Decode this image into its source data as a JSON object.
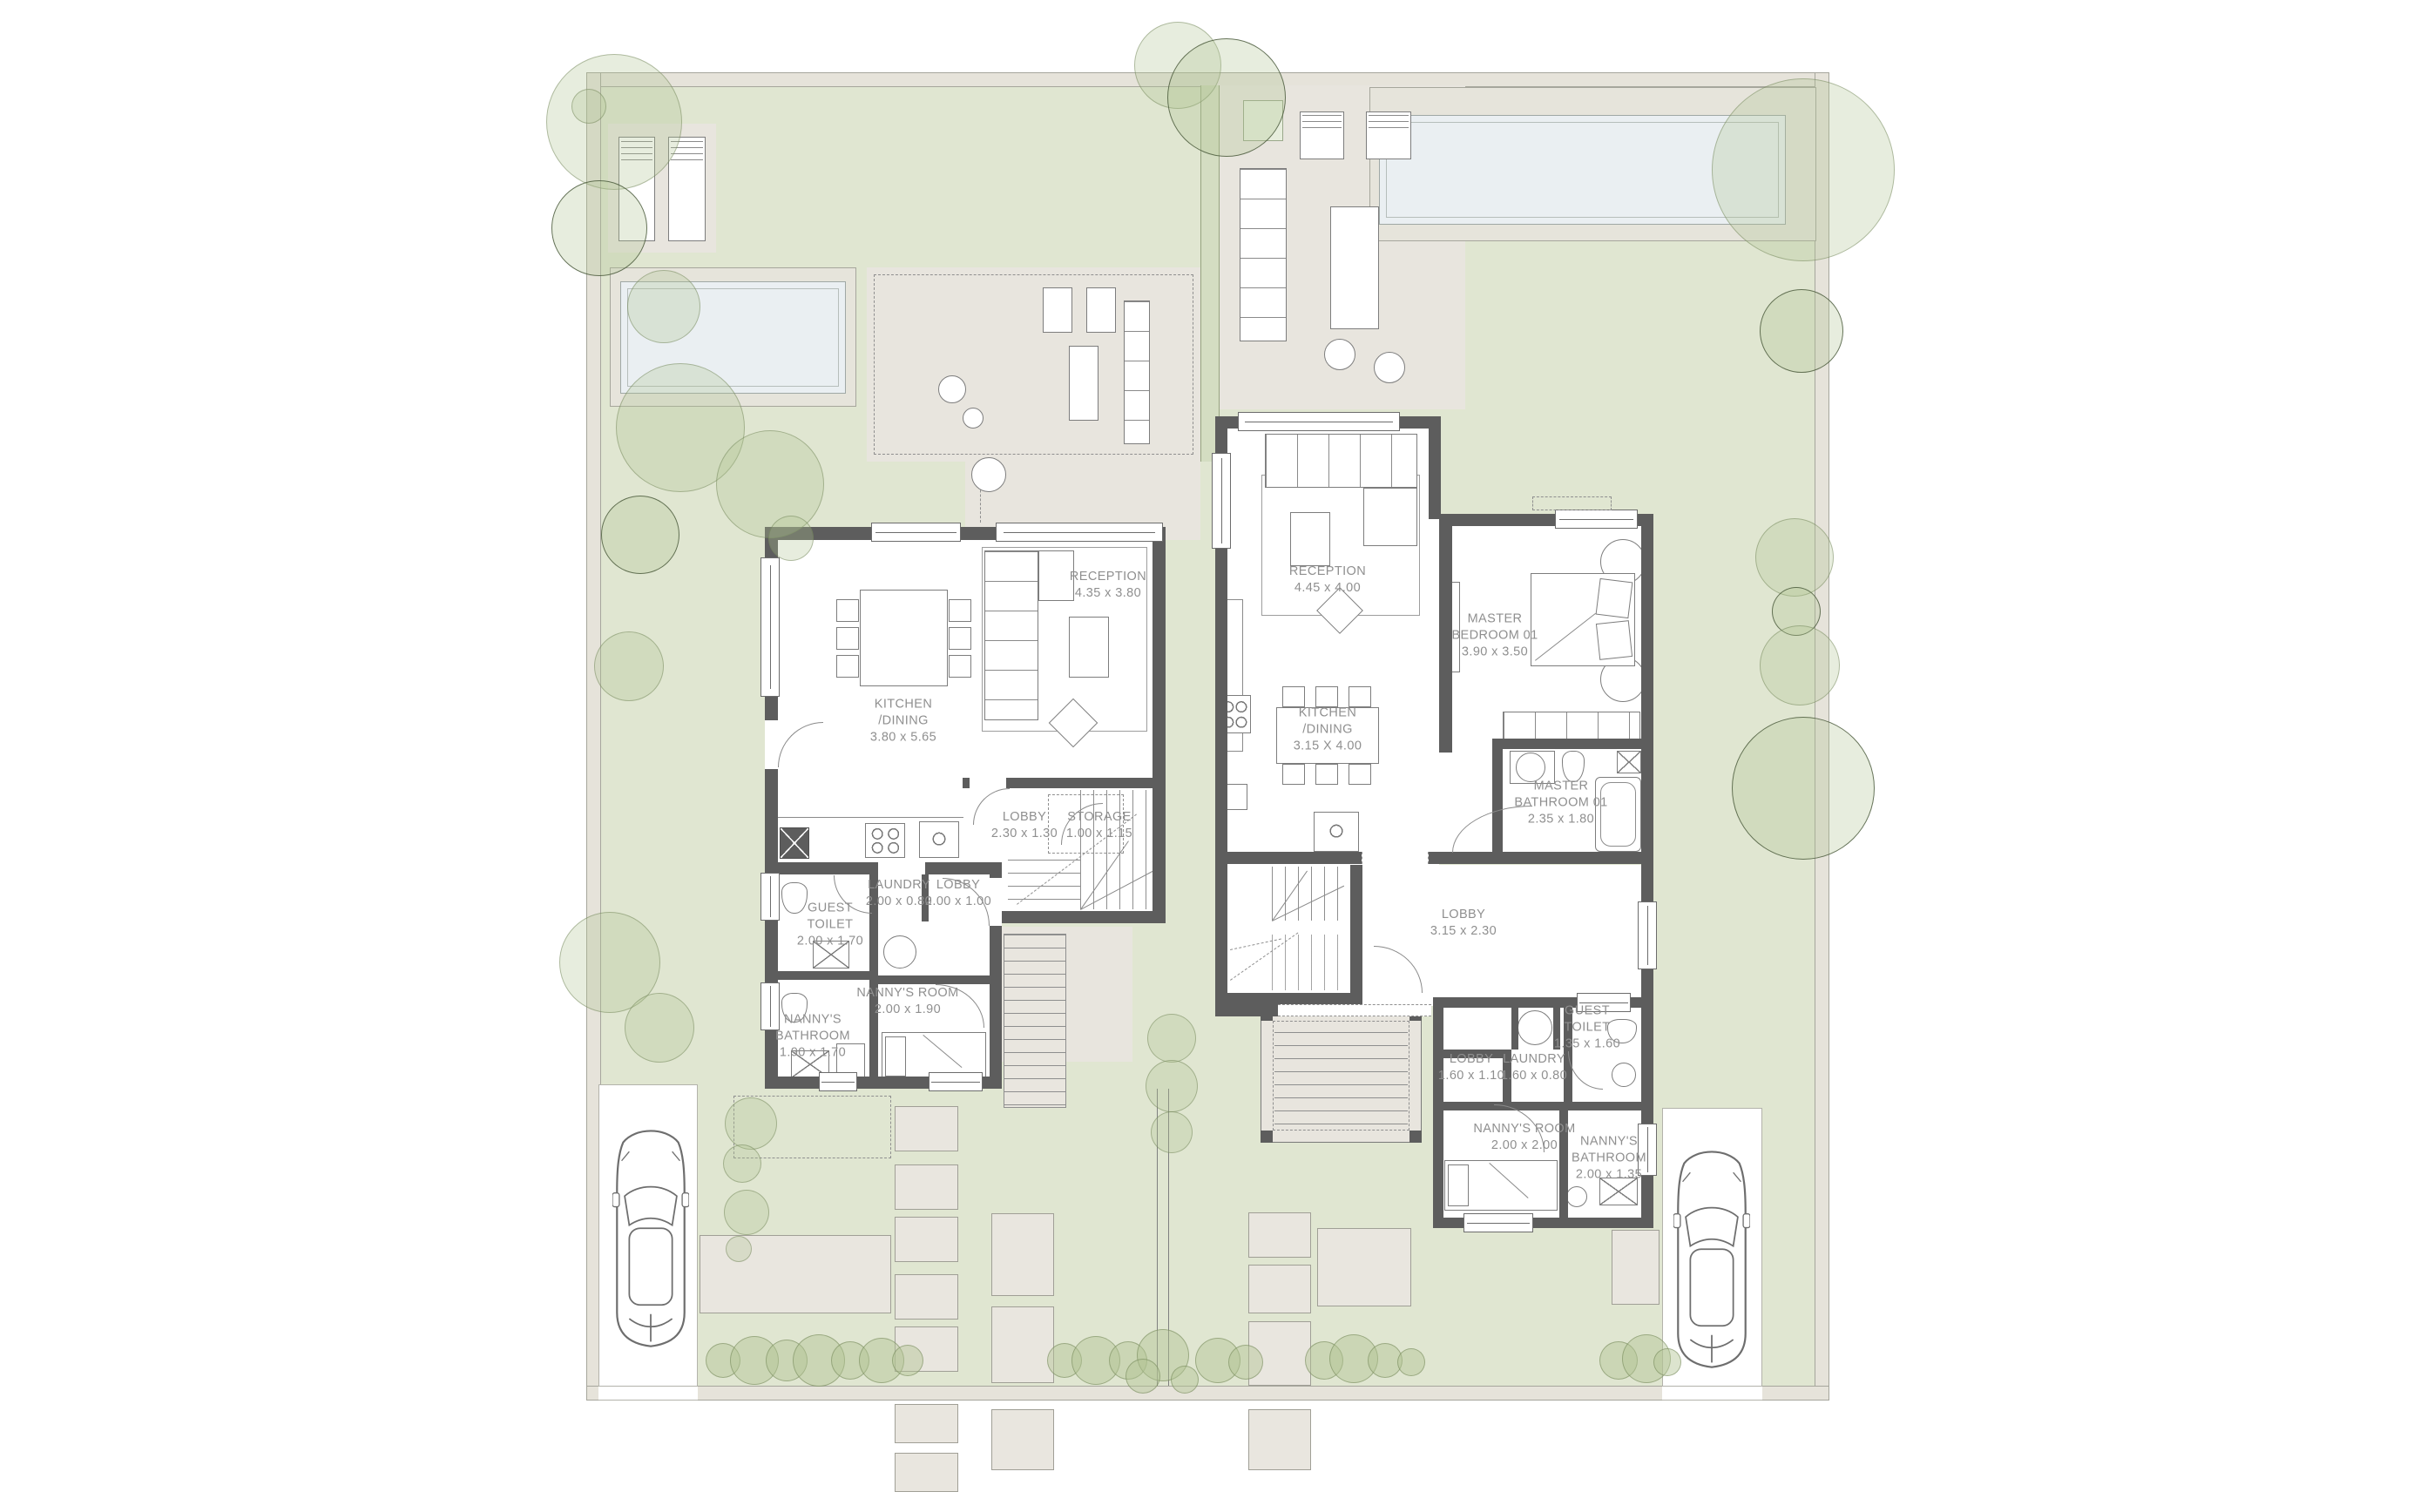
{
  "plan": {
    "unit_a": {
      "rooms": [
        {
          "name": "RECEPTION",
          "dims": "4.35 x 3.80"
        },
        {
          "name": "KITCHEN\n/DINING",
          "dims": "3.80 x 5.65"
        },
        {
          "name": "LOBBY",
          "dims": "2.30 x 1.30"
        },
        {
          "name": "STORAGE",
          "dims": "1.00 x 1.15"
        },
        {
          "name": "LAUNDRY",
          "dims": "2.00 x 0.80"
        },
        {
          "name": "LOBBY",
          "dims": "2.00 x 1.00"
        },
        {
          "name": "GUEST\nTOILET",
          "dims": "2.00 x 1.70"
        },
        {
          "name": "NANNY'S ROOM",
          "dims": "2.00 x 1.90"
        },
        {
          "name": "NANNY'S\nBATHROOM",
          "dims": "1.90 x 1.70"
        }
      ]
    },
    "unit_b": {
      "rooms": [
        {
          "name": "RECEPTION",
          "dims": "4.45 x 4.00"
        },
        {
          "name": "KITCHEN\n/DINING",
          "dims": "3.15 X 4.00"
        },
        {
          "name": "MASTER\nBEDROOM 01",
          "dims": "3.90 x 3.50"
        },
        {
          "name": "MASTER\nBATHROOM 01",
          "dims": "2.35 x 1.80"
        },
        {
          "name": "LOBBY",
          "dims": "3.15 x 2.30"
        },
        {
          "name": "GUEST\nTOILET",
          "dims": "1.35 x 1.60"
        },
        {
          "name": "LOBBY",
          "dims": "1.60 x 1.10"
        },
        {
          "name": "LAUNDRY",
          "dims": "1.60 x 0.80"
        },
        {
          "name": "NANNY'S ROOM",
          "dims": "2.00 x 2.00"
        },
        {
          "name": "NANNY'S\nBATHROOM",
          "dims": "2.00 x 1.35"
        }
      ]
    },
    "colors": {
      "garden": "#e0e6d1",
      "hardscape": "#e8e5de",
      "pool_water": "#eaeff2",
      "walls": "#5d5d5d",
      "label_text": "#8f8f8f",
      "tree": "#b1c492"
    }
  }
}
